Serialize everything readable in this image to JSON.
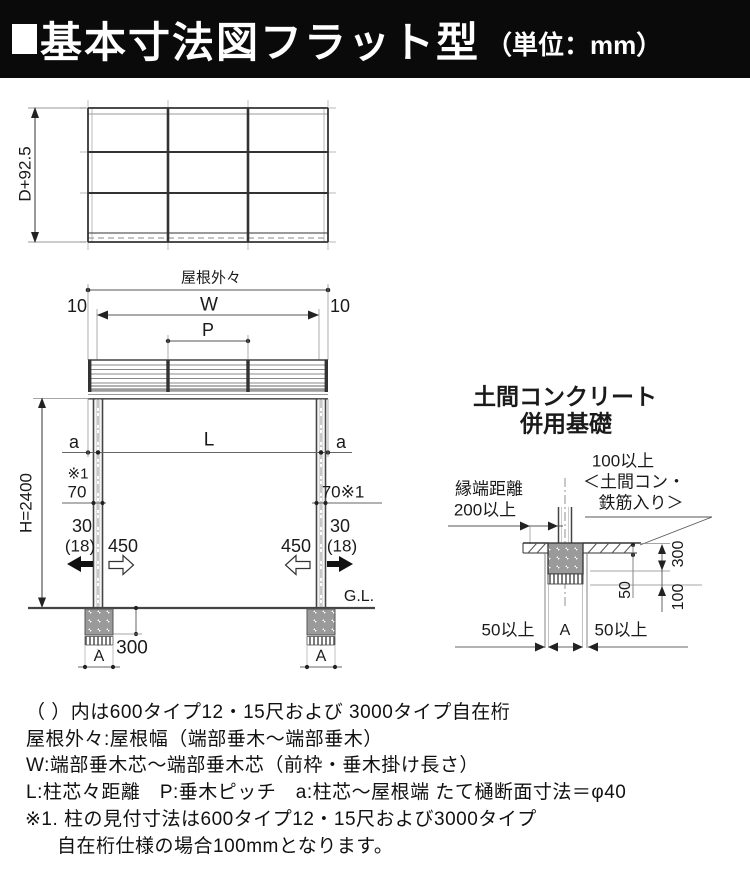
{
  "colors": {
    "header_bg": "#0a0a0a",
    "line": "#333333",
    "text": "#111111",
    "bg": "#ffffff"
  },
  "header": {
    "title": "基本寸法図フラット型",
    "unit": "（単位：mm）"
  },
  "plan_view": {
    "dim_depth": "D+92.5"
  },
  "elevation": {
    "roof_overall_label": "屋根外々",
    "dim_10_left": "10",
    "dim_w": "W",
    "dim_10_right": "10",
    "dim_p": "P",
    "dim_a_left": "a",
    "dim_l": "L",
    "dim_a_right": "a",
    "note_ref_left": "※1",
    "dim_70_left": "70",
    "dim_70_right": "70※1",
    "dim_30_left": "30",
    "dim_18_left": "(18)",
    "dim_450_left": "450",
    "dim_450_right": "450",
    "dim_30_right": "30",
    "dim_18_right": "(18)",
    "dim_h": "H=2400",
    "ground_label": "G.L.",
    "dim_300": "300",
    "dim_a_foot_left": "A",
    "dim_a_foot_right": "A"
  },
  "foundation_detail": {
    "title_line1": "土間コンクリート",
    "title_line2": "併用基礎",
    "edge_distance_line1": "縁端距離",
    "edge_distance_line2": "200以上",
    "slab_note_line1": "100以上",
    "slab_note_line2": "＜土間コン・",
    "slab_note_line3": "鉄筋入り＞",
    "dim_50min_left": "50以上",
    "dim_a": "A",
    "dim_50min_right": "50以上",
    "dim_300": "300",
    "dim_100": "100",
    "dim_50": "50"
  },
  "notes": {
    "lines": [
      "（ ）内は600タイプ12・15尺および 3000タイプ自在桁",
      "屋根外々:屋根幅（端部垂木〜端部垂木）",
      "W:端部垂木芯〜端部垂木芯（前枠・垂木掛け長さ）",
      "L:柱芯々距離　P:垂木ピッチ　a:柱芯〜屋根端 たて樋断面寸法＝φ40",
      "※1. 柱の見付寸法は600タイプ12・15尺および3000タイプ",
      "自在桁仕様の場合100mmとなります。"
    ]
  }
}
